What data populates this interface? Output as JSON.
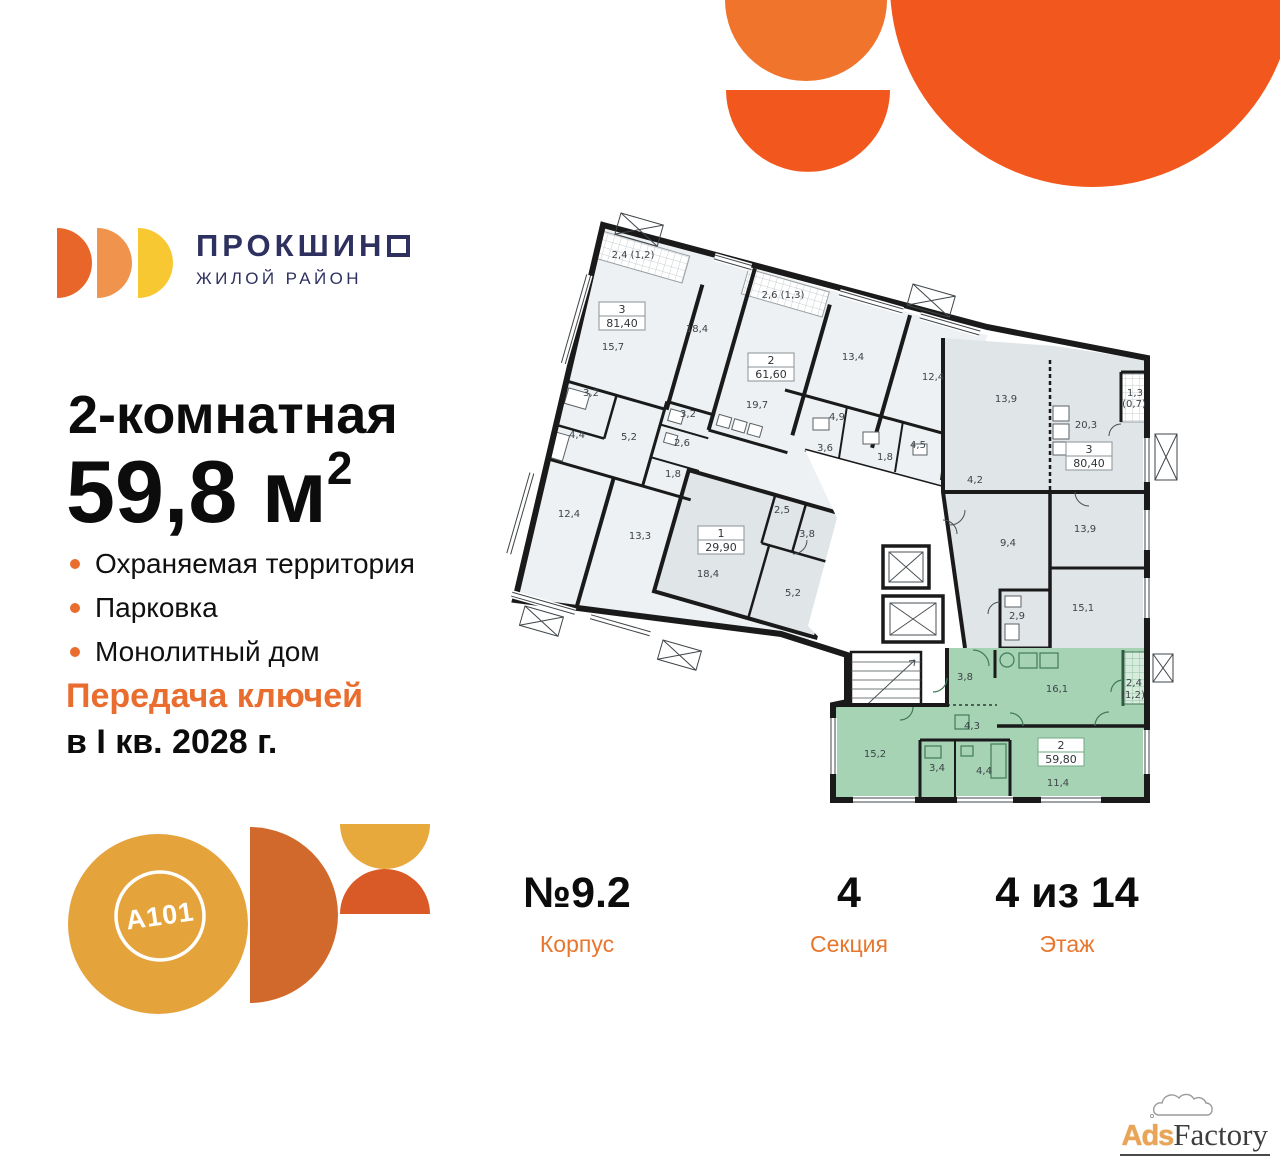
{
  "brand": {
    "name": "ПРОКШИНО",
    "tagline": "ЖИЛОЙ РАЙОН"
  },
  "offer": {
    "rooms_line": "2-комнатная",
    "area_value": "59,8",
    "area_unit": " м",
    "area_sup": "2"
  },
  "features": [
    {
      "label": "Охраняемая территория"
    },
    {
      "label": "Парковка"
    },
    {
      "label": "Монолитный дом"
    }
  ],
  "handover": {
    "line1": "Передача ключей",
    "line2": "в I кв. 2028 г."
  },
  "building": {
    "number": "№9.2",
    "number_label": "Корпус",
    "section": "4",
    "section_label": "Секция",
    "floor": "4 из 14",
    "floor_label": "Этаж"
  },
  "developer": {
    "logo_text": "A101"
  },
  "watermark": {
    "ads": "Ads",
    "factory": "Factory"
  },
  "colors": {
    "accent_orange": "#E96D2F",
    "decor_orange_dark": "#F2581D",
    "decor_orange_light": "#F0742C",
    "brand_navy": "#2E3160",
    "brand_disc1": "#E8662A",
    "brand_disc2": "#F0934C",
    "brand_disc3": "#F8C832",
    "dev_amber": "#E5A33C",
    "dev_rust": "#D2692C",
    "plan_highlight_green": "#A7D3B5",
    "plan_gray": "#E0E5E8",
    "plan_light": "#EDF1F3",
    "plan_wall": "#1A1A1A"
  },
  "floor_plan": {
    "selected_apartment": {
      "rooms": "2",
      "total_area": "59,80"
    },
    "apartments": [
      {
        "num": "3",
        "area": "81,40",
        "x": 104,
        "y": 92,
        "hl": false
      },
      {
        "num": "2",
        "area": "61,60",
        "x": 253,
        "y": 143,
        "hl": false
      },
      {
        "num": "1",
        "area": "29,90",
        "x": 203,
        "y": 316,
        "hl": false
      },
      {
        "num": "3",
        "area": "80,40",
        "x": 571,
        "y": 232,
        "hl": false
      },
      {
        "num": "2",
        "area": "59,80",
        "x": 543,
        "y": 528,
        "hl": true
      }
    ],
    "room_labels": [
      {
        "t": "2,4 (1,2)",
        "x": 138,
        "y": 48,
        "s": 9
      },
      {
        "t": "15,7",
        "x": 118,
        "y": 140
      },
      {
        "t": "18,4",
        "x": 202,
        "y": 122
      },
      {
        "t": "2,6 (1,3)",
        "x": 288,
        "y": 88,
        "s": 9
      },
      {
        "t": "19,7",
        "x": 262,
        "y": 198
      },
      {
        "t": "13,4",
        "x": 358,
        "y": 150
      },
      {
        "t": "12,4",
        "x": 438,
        "y": 170
      },
      {
        "t": "3,2",
        "x": 96,
        "y": 186,
        "s": 9
      },
      {
        "t": "4,4",
        "x": 82,
        "y": 228,
        "s": 9
      },
      {
        "t": "5,2",
        "x": 134,
        "y": 230,
        "s": 9
      },
      {
        "t": "3,2",
        "x": 193,
        "y": 207,
        "s": 9
      },
      {
        "t": "2,6",
        "x": 187,
        "y": 236,
        "s": 9
      },
      {
        "t": "1,8",
        "x": 178,
        "y": 267,
        "s": 9
      },
      {
        "t": "4,9",
        "x": 342,
        "y": 210,
        "s": 9
      },
      {
        "t": "3,6",
        "x": 330,
        "y": 241,
        "s": 9
      },
      {
        "t": "1,8",
        "x": 390,
        "y": 250,
        "s": 9
      },
      {
        "t": "4,5",
        "x": 423,
        "y": 238,
        "s": 9
      },
      {
        "t": "4,2",
        "x": 480,
        "y": 273,
        "s": 9
      },
      {
        "t": "12,4",
        "x": 74,
        "y": 307
      },
      {
        "t": "13,3",
        "x": 145,
        "y": 329
      },
      {
        "t": "18,4",
        "x": 213,
        "y": 367
      },
      {
        "t": "2,5",
        "x": 287,
        "y": 303,
        "s": 9
      },
      {
        "t": "3,8",
        "x": 312,
        "y": 327,
        "s": 9
      },
      {
        "t": "5,2",
        "x": 298,
        "y": 386,
        "s": 9
      },
      {
        "t": "13,9",
        "x": 511,
        "y": 192
      },
      {
        "t": "20,3",
        "x": 591,
        "y": 218
      },
      {
        "t": "1,3",
        "x": 640,
        "y": 186,
        "s": 8.5
      },
      {
        "t": "(0,7)",
        "x": 639,
        "y": 197,
        "s": 8.5
      },
      {
        "t": "9,4",
        "x": 513,
        "y": 336
      },
      {
        "t": "13,9",
        "x": 590,
        "y": 322
      },
      {
        "t": "15,1",
        "x": 588,
        "y": 401
      },
      {
        "t": "2,9",
        "x": 522,
        "y": 409,
        "s": 9
      },
      {
        "t": "3,8",
        "x": 470,
        "y": 470,
        "s": 9
      },
      {
        "t": "16,1",
        "x": 562,
        "y": 482
      },
      {
        "t": "2,4",
        "x": 639,
        "y": 476,
        "s": 8
      },
      {
        "t": "(1,2)",
        "x": 638,
        "y": 488,
        "s": 8
      },
      {
        "t": "4,3",
        "x": 477,
        "y": 519,
        "s": 9
      },
      {
        "t": "15,2",
        "x": 380,
        "y": 547
      },
      {
        "t": "3,4",
        "x": 442,
        "y": 561,
        "s": 9
      },
      {
        "t": "4,4",
        "x": 489,
        "y": 564,
        "s": 9
      },
      {
        "t": "11,4",
        "x": 563,
        "y": 576
      }
    ]
  }
}
